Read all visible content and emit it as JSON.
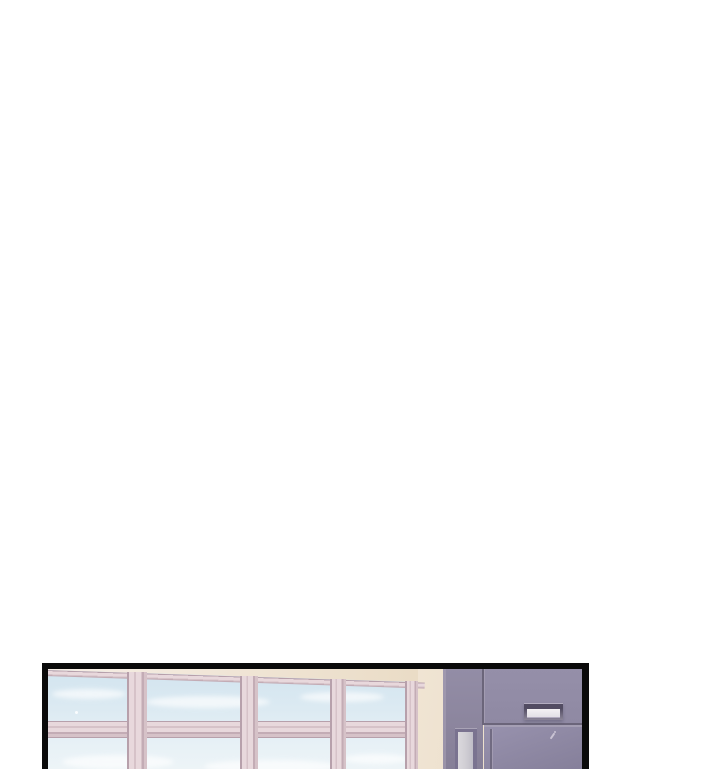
{
  "scene": {
    "description": "Single borderless-page webtoon strip: one black-framed panel at the bottom of a white page showing an empty school corridor interior; no text, no UI controls.",
    "panel": {
      "kind": "comic-panel",
      "position": "bottom of page, cropped by the bottom edge",
      "border": "thick black frame, no bottom edge visible"
    },
    "objects": [
      {
        "name": "window-wall",
        "label": "bank of four pink-framed windows showing pale blue sky with soft clouds",
        "window_count": 4
      },
      {
        "name": "cream-wall",
        "label": "cream wall band above and to the right of the windows"
      },
      {
        "name": "purple-wall",
        "label": "grayish-purple wall and door section with panel seams"
      },
      {
        "name": "door-nameplate",
        "label": "blank white nameplate in a dark holder"
      },
      {
        "name": "door-window",
        "label": "narrow frosted vertical window in the door"
      },
      {
        "name": "scratch-mark",
        "label": "small light scratch on the door face"
      }
    ]
  },
  "colors": {
    "page_bg": "#ffffff",
    "panel_border": "#0a0a0a",
    "cream_1": "#f6eee6",
    "cream_2": "#f1e6d6",
    "cream_3": "#eadcc6",
    "frame_light": "#e8d8dc",
    "frame_mid": "#d6c2c8",
    "frame_dark": "#c3acb5",
    "frame_edge": "#b7a0ab",
    "sky_1": "#d2e4ef",
    "sky_2": "#dceaf2",
    "sky_3": "#e6f0f6",
    "sky_4": "#edf4f7",
    "cloud": "#ffffff",
    "purple_wall_1": "#938da6",
    "purple_wall_2": "#867f97",
    "transom_1": "#958fa9",
    "transom_2": "#8f89a3",
    "seam_dark": "#6b657a",
    "seam_light": "#a9a3b6",
    "door_1": "#9892ae",
    "door_2": "#8d87a2",
    "door_3": "#847e99",
    "glass_frame": "#7a7390",
    "glass_1": "#dbd9dd",
    "glass_2": "#cfcdd3",
    "glass_3": "#bfbdc7",
    "plate_slot_1": "#524c62",
    "plate_slot_2": "#8b8598",
    "plate_face_1": "#f4f2f4",
    "plate_face_2": "#e3e0e6",
    "plate_edge": "#b3adc0",
    "scratch": "#c9c3d3"
  }
}
